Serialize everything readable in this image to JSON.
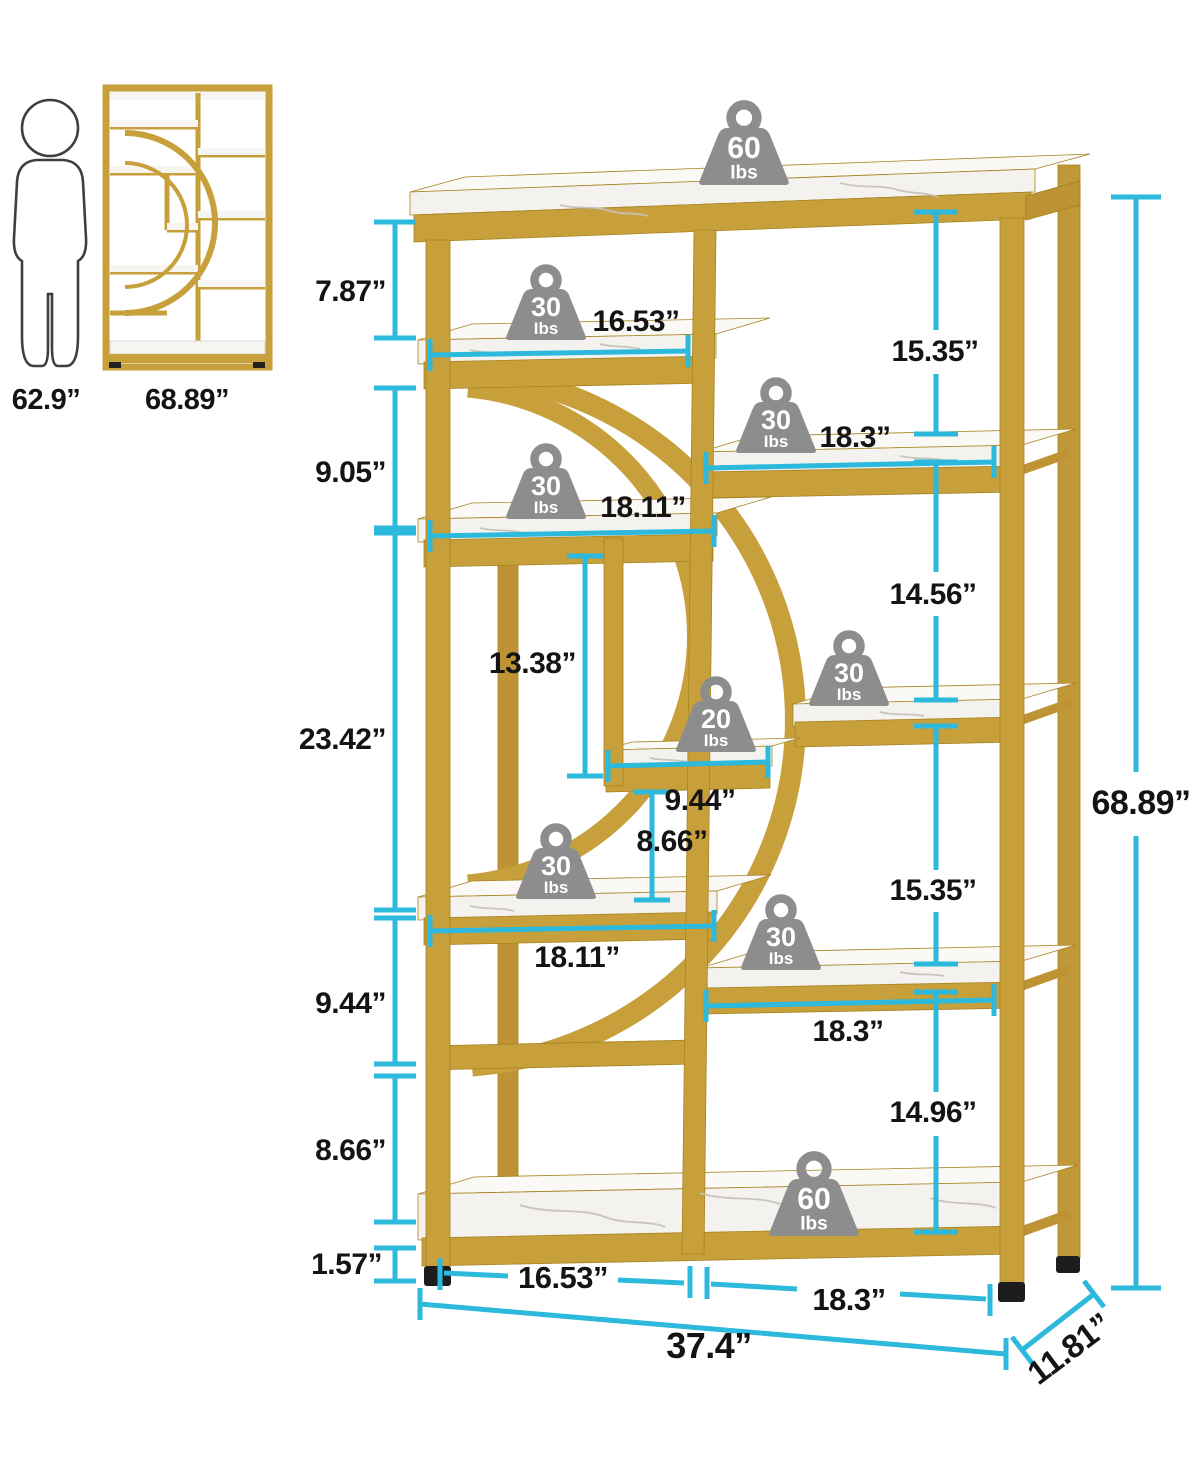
{
  "reference": {
    "person_height": "62.9”",
    "unit_height": "68.89”"
  },
  "weight_badges": [
    {
      "value": "60",
      "unit": "Ibs"
    },
    {
      "value": "30",
      "unit": "Ibs"
    },
    {
      "value": "30",
      "unit": "Ibs"
    },
    {
      "value": "30",
      "unit": "Ibs"
    },
    {
      "value": "30",
      "unit": "Ibs"
    },
    {
      "value": "20",
      "unit": "Ibs"
    },
    {
      "value": "30",
      "unit": "Ibs"
    },
    {
      "value": "30",
      "unit": "Ibs"
    },
    {
      "value": "60",
      "unit": "Ibs"
    }
  ],
  "dimensions": {
    "left_chain": [
      "7.87”",
      "9.05”",
      "23.42”",
      "9.44”",
      "8.66”",
      "1.57”"
    ],
    "right_chain": [
      "15.35”",
      "14.56”",
      "15.35”",
      "14.96”"
    ],
    "overall_height": "68.89”",
    "inner": {
      "tier2_width": "16.53”",
      "right_tier1_width": "18.3”",
      "tier3_width": "18.11”",
      "middle_height": "13.38”",
      "small_shelf_width": "9.44”",
      "small_gap_height": "8.66”",
      "tier5_width": "18.11”",
      "right_tier3_width": "18.3”"
    },
    "bottom": {
      "left_section": "16.53”",
      "right_section": "18.3”",
      "overall_width": "37.4”",
      "depth": "11.81”"
    }
  }
}
